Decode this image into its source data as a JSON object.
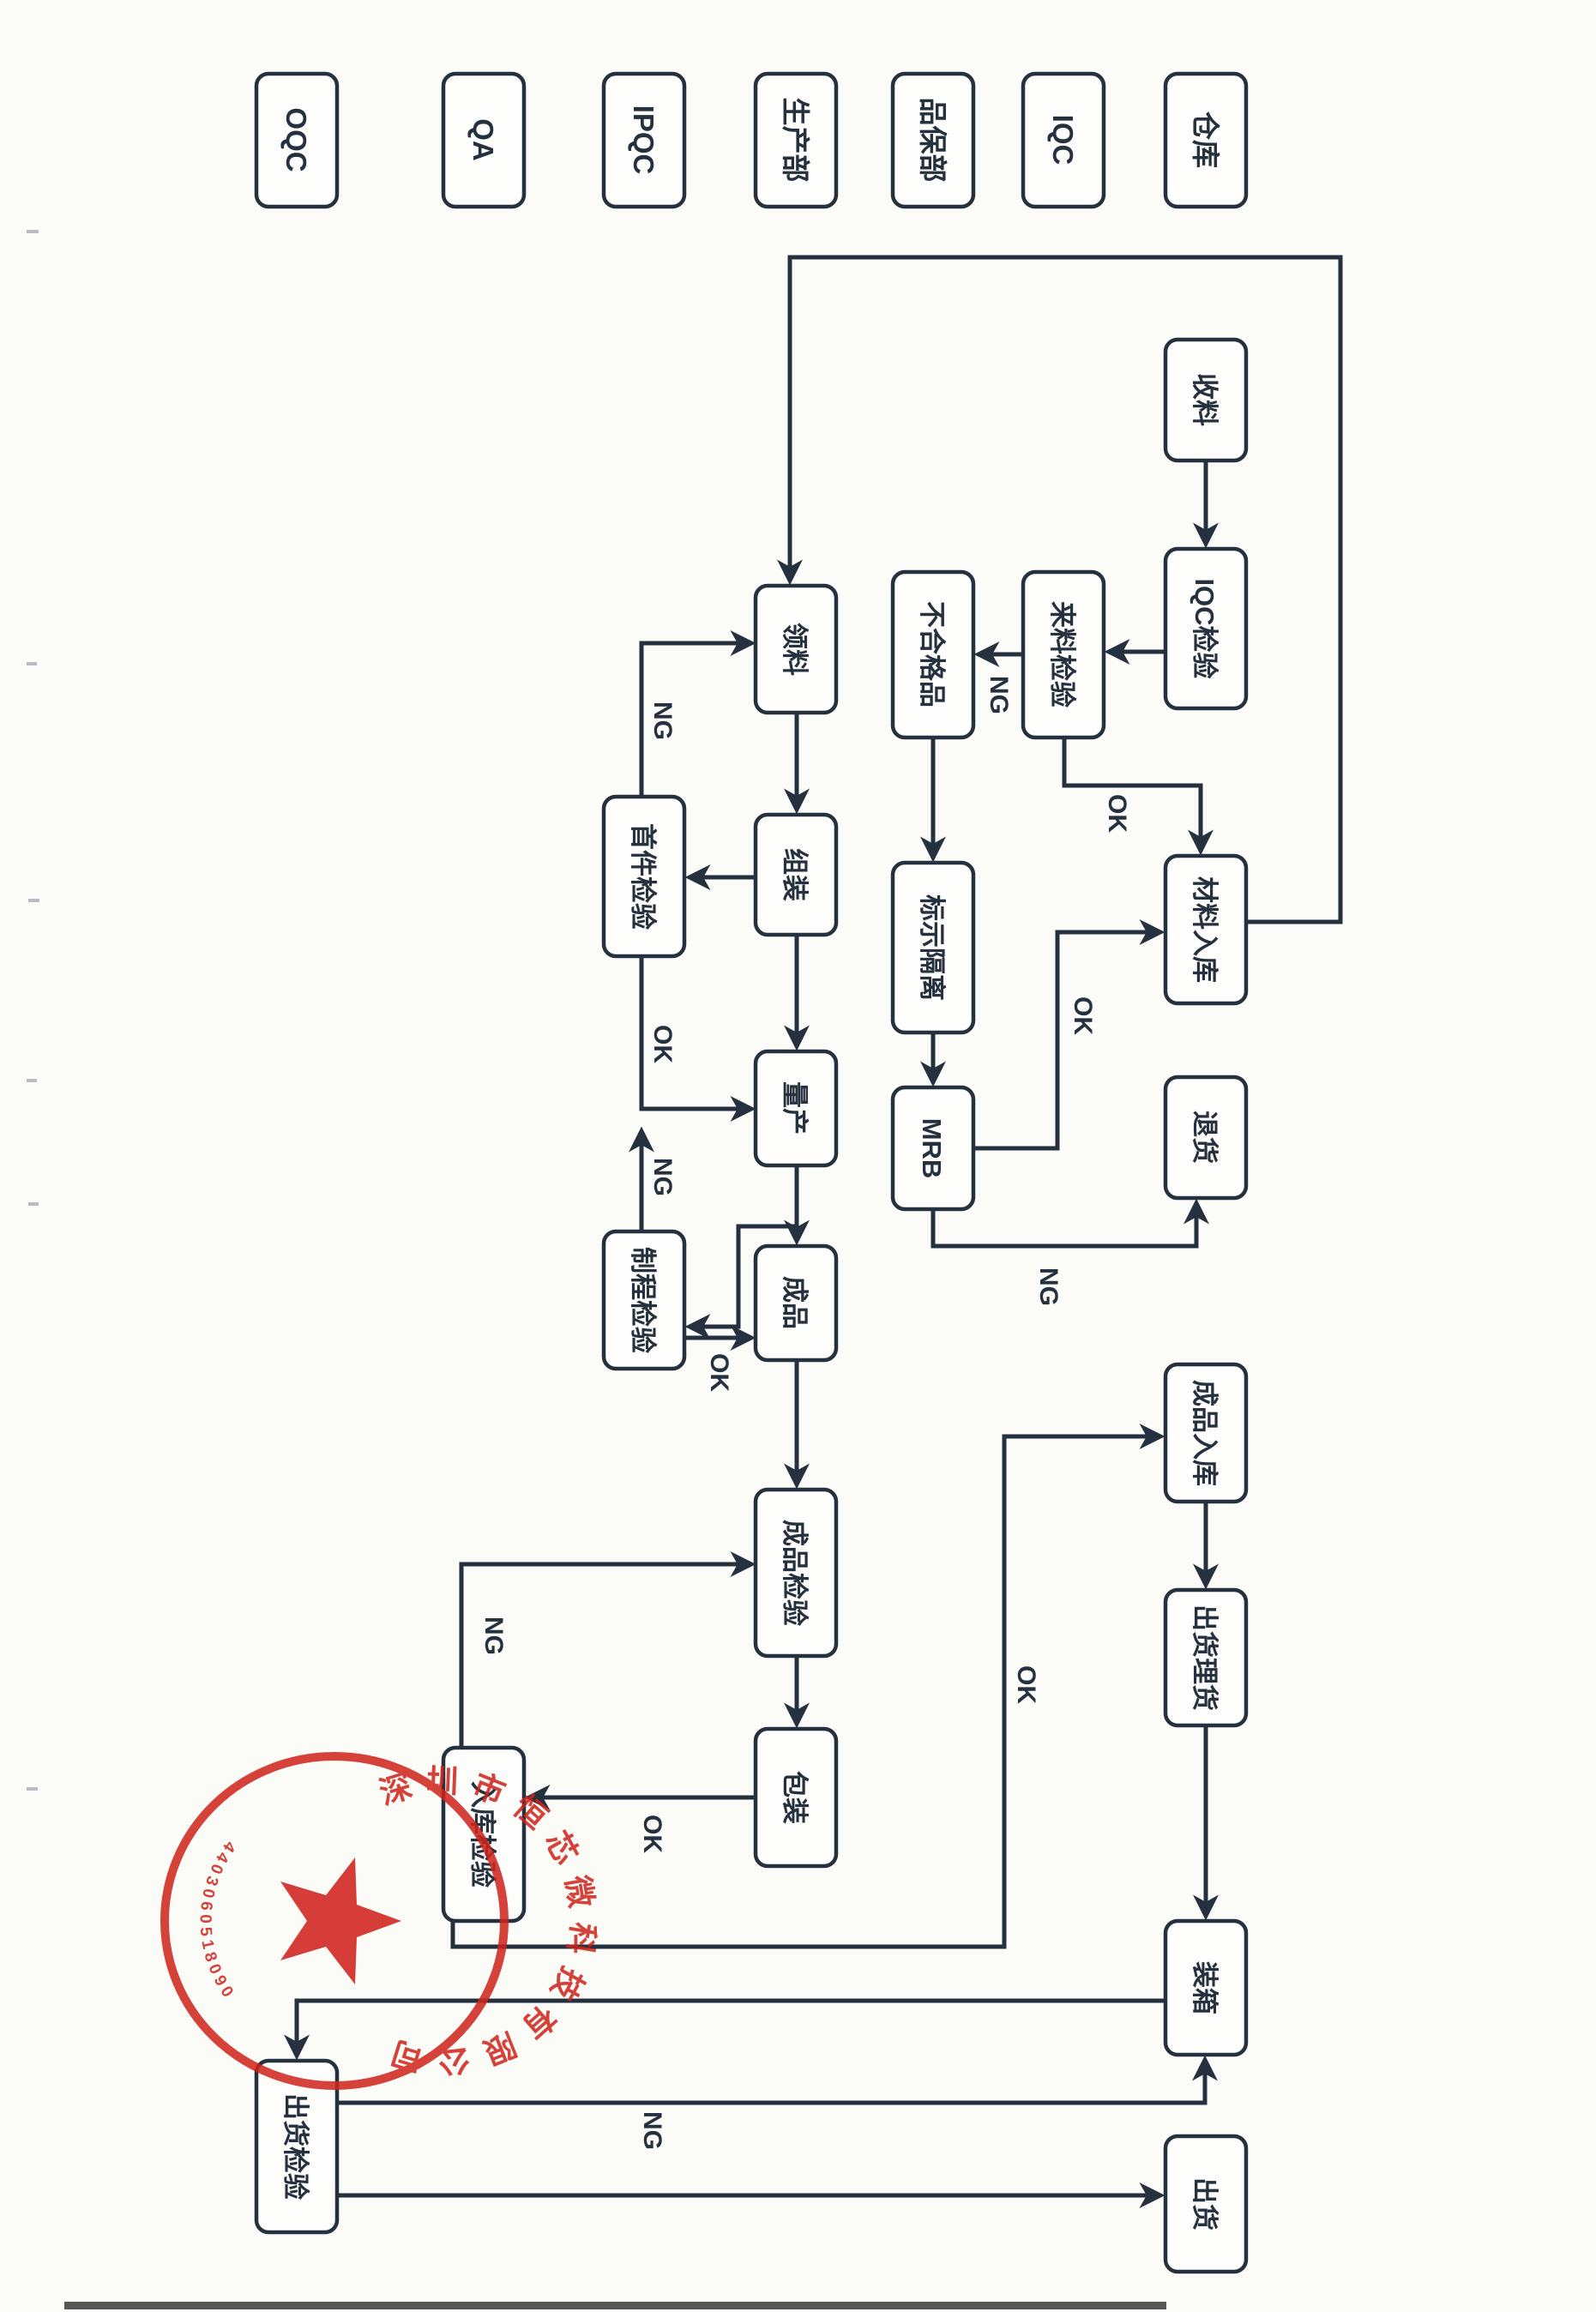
{
  "page": {
    "background": "#fbfbf8",
    "ink_color": "#26313f",
    "stamp_color": "#ce241c"
  },
  "lanes": [
    {
      "id": "warehouse",
      "label": "仓库"
    },
    {
      "id": "iqc",
      "label": "IQC"
    },
    {
      "id": "quality",
      "label": "品保部"
    },
    {
      "id": "production",
      "label": "生产部"
    },
    {
      "id": "ipqc",
      "label": "IPQC"
    },
    {
      "id": "qa",
      "label": "QA"
    },
    {
      "id": "oqc",
      "label": "OQC"
    }
  ],
  "nodes": {
    "receive": {
      "label": "收料"
    },
    "iqc_check": {
      "label": "IQC检验"
    },
    "incoming_check": {
      "label": "来料检验"
    },
    "nonconforming": {
      "label": "不合格品"
    },
    "quarantine": {
      "label": "标示隔离"
    },
    "mrb": {
      "label": "MRB"
    },
    "material_in": {
      "label": "材料入库"
    },
    "returns": {
      "label": "退货"
    },
    "requisition": {
      "label": "领料"
    },
    "assembly": {
      "label": "组装"
    },
    "first_article": {
      "label": "首件检验"
    },
    "mass_prod": {
      "label": "量产"
    },
    "inprocess": {
      "label": "制程检验"
    },
    "finished": {
      "label": "成品"
    },
    "finished_check": {
      "label": "成品检验"
    },
    "packaging": {
      "label": "包装"
    },
    "warehousing_check": {
      "label": "入库检验"
    },
    "finished_in": {
      "label": "成品入库"
    },
    "tally": {
      "label": "出货理货"
    },
    "cartons": {
      "label": "装箱"
    },
    "outgoing_check": {
      "label": "出货检验"
    },
    "ship": {
      "label": "出货"
    }
  },
  "edge_labels": {
    "incoming_ng": "NG",
    "incoming_ok": "OK",
    "mrb_ok": "OK",
    "mrb_ng": "NG",
    "first_ng": "NG",
    "first_ok": "OK",
    "inprocess_ng": "NG",
    "inprocess_ok": "OK",
    "packaging_ok": "OK",
    "warehousing_ng": "NG",
    "warehousing_ok": "OK",
    "outgoing_ng": "NG"
  },
  "stamp": {
    "company": "深圳市恒芯微科技有限公司",
    "serial": "4403060518090"
  }
}
